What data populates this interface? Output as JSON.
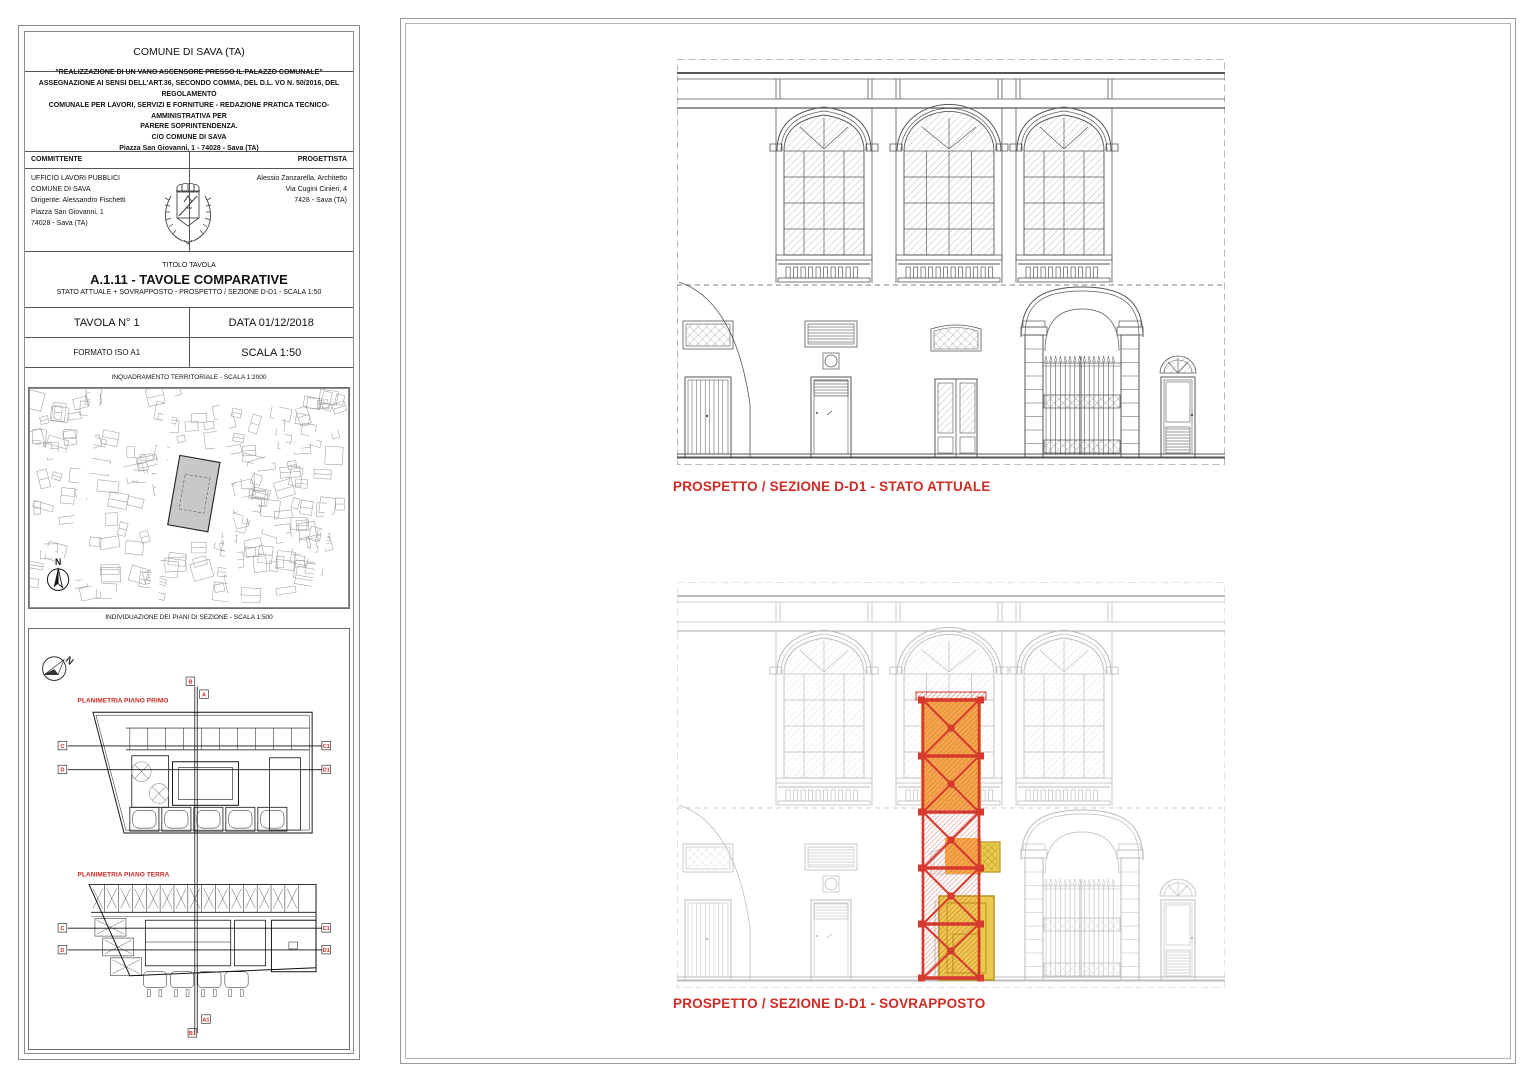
{
  "sheet": {
    "comune": "COMUNE DI SAVA (TA)",
    "project_lines": [
      "\"REALIZZAZIONE DI UN VANO ASCENSORE PRESSO IL PALAZZO COMUNALE\"",
      "ASSEGNAZIONE AI SENSI DELL'ART.36, SECONDO COMMA, DEL D.L. VO N. 50/2016, DEL REGOLAMENTO",
      "COMUNALE PER LAVORI, SERVIZI E FORNITURE - REDAZIONE PRATICA TECNICO-AMMINISTRATIVA PER",
      "PARERE SOPRINTENDENZA.",
      "C/O COMUNE DI SAVA",
      "Piazza San Giovanni, 1 - 74028 - Sava (TA)"
    ],
    "committente": {
      "label": "COMMITTENTE",
      "lines": [
        "UFFICIO LAVORI PUBBLICI",
        "COMUNE DI SAVA",
        "Dirigente: Alessandro Fischetti",
        "Piazza San Giovanni, 1",
        "74028 - Sava (TA)"
      ]
    },
    "progettista": {
      "label": "PROGETTISTA",
      "lines": [
        "Alessio Zanzarella, Architetto",
        "Via Cugini Cinieri, 4",
        "7428 - Sava (TA)"
      ]
    },
    "titolo": {
      "kicker": "TITOLO TAVOLA",
      "title": "A.1.11 - TAVOLE COMPARATIVE",
      "subtitle": "STATO ATTUALE + SOVRAPPOSTO - PROSPETTO / SEZIONE D-D1 - SCALA 1:50"
    },
    "tavola_n": "TAVOLA N° 1",
    "data_label": "DATA 01/12/2018",
    "formato": "FORMATO ISO A1",
    "scala": "SCALA 1:50",
    "map_caption": "INQUADRAMENTO TERRITORIALE - SCALA 1:2000",
    "plans_caption": "INDIVIDUAZIONE DEI PIANI DI SEZIONE - SCALA 1:500",
    "plan1_label": "PLANIMETRIA PIANO PRIMO",
    "plan2_label": "PLANIMETRIA PIANO TERRA",
    "north_label": "N",
    "section_labels": {
      "b": "B",
      "a": "A",
      "c": "C",
      "c1": "C1",
      "d": "D",
      "d1": "D1",
      "a1": "A1",
      "b1": "B1"
    }
  },
  "drawings": {
    "top_caption": "PROSPETTO / SEZIONE D-D1 - STATO ATTUALE",
    "bottom_caption": "PROSPETTO / SEZIONE D-D1 - SOVRAPPOSTO"
  },
  "colors": {
    "red_label": "#cf2b24",
    "line_dark": "#565656",
    "shaft_red": "#d63a2e",
    "shaft_red_hatch": "#d84a36",
    "shaft_orange": "#f3a33c",
    "shaft_yellow": "#e9c94e",
    "shaft_yellow_dark": "#b8941f",
    "map_highlight": "#c8c8c8"
  }
}
